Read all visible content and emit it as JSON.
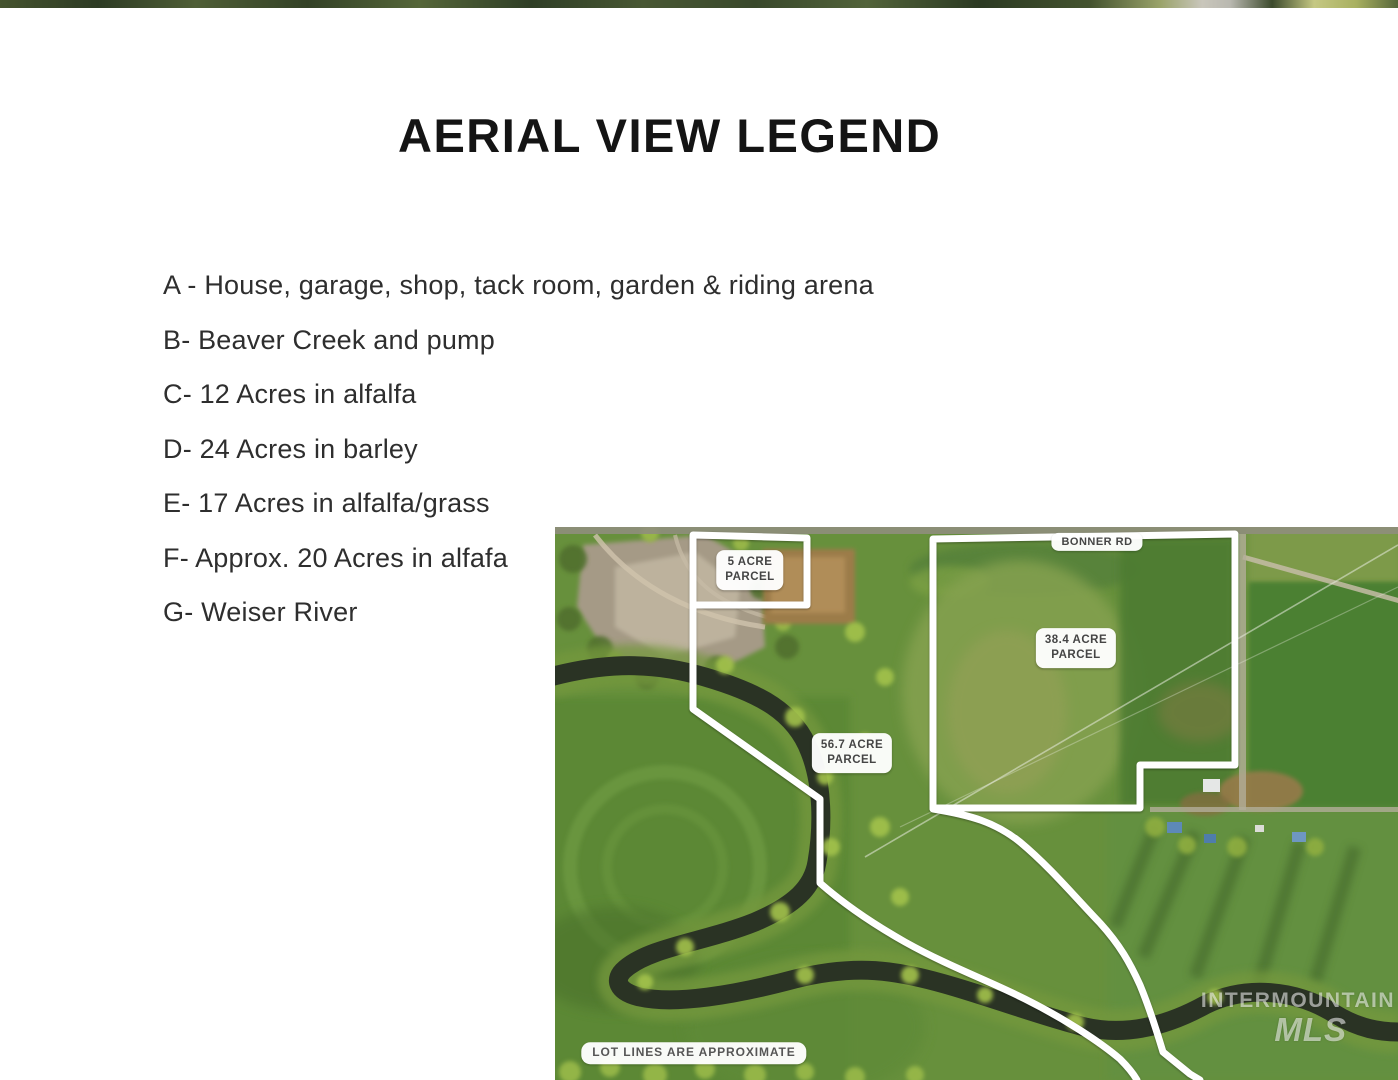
{
  "page": {
    "title": "AERIAL VIEW LEGEND"
  },
  "legend": {
    "items": [
      {
        "label": "A - House, garage, shop, tack room, garden & riding arena"
      },
      {
        "label": "B- Beaver Creek and pump"
      },
      {
        "label": "C- 12 Acres in alfalfa"
      },
      {
        "label": "D- 24 Acres in barley"
      },
      {
        "label": "E- 17 Acres in alfalfa/grass"
      },
      {
        "label": "F- Approx. 20 Acres in alfafa"
      },
      {
        "label": "G- Weiser River"
      }
    ]
  },
  "aerial": {
    "road_label": "BONNER RD",
    "parcels": {
      "five_acre": {
        "line1": "5 ACRE",
        "line2": "PARCEL"
      },
      "large": {
        "line1": "38.4 ACRE",
        "line2": "PARCEL"
      },
      "mid": {
        "line1": "56.7 ACRE",
        "line2": "PARCEL"
      }
    },
    "disclaimer": "LOT LINES ARE APPROXIMATE",
    "watermark": {
      "line1": "INTERMOUNTAIN",
      "line2": "MLS"
    }
  },
  "colors": {
    "boundary_line": "#ffffff",
    "chip_background": "#ffffff",
    "chip_text": "#454545",
    "title_text": "#141414",
    "legend_text": "#2e2e2e",
    "field_green": "#67903c",
    "river_dark": "#2a3324"
  }
}
